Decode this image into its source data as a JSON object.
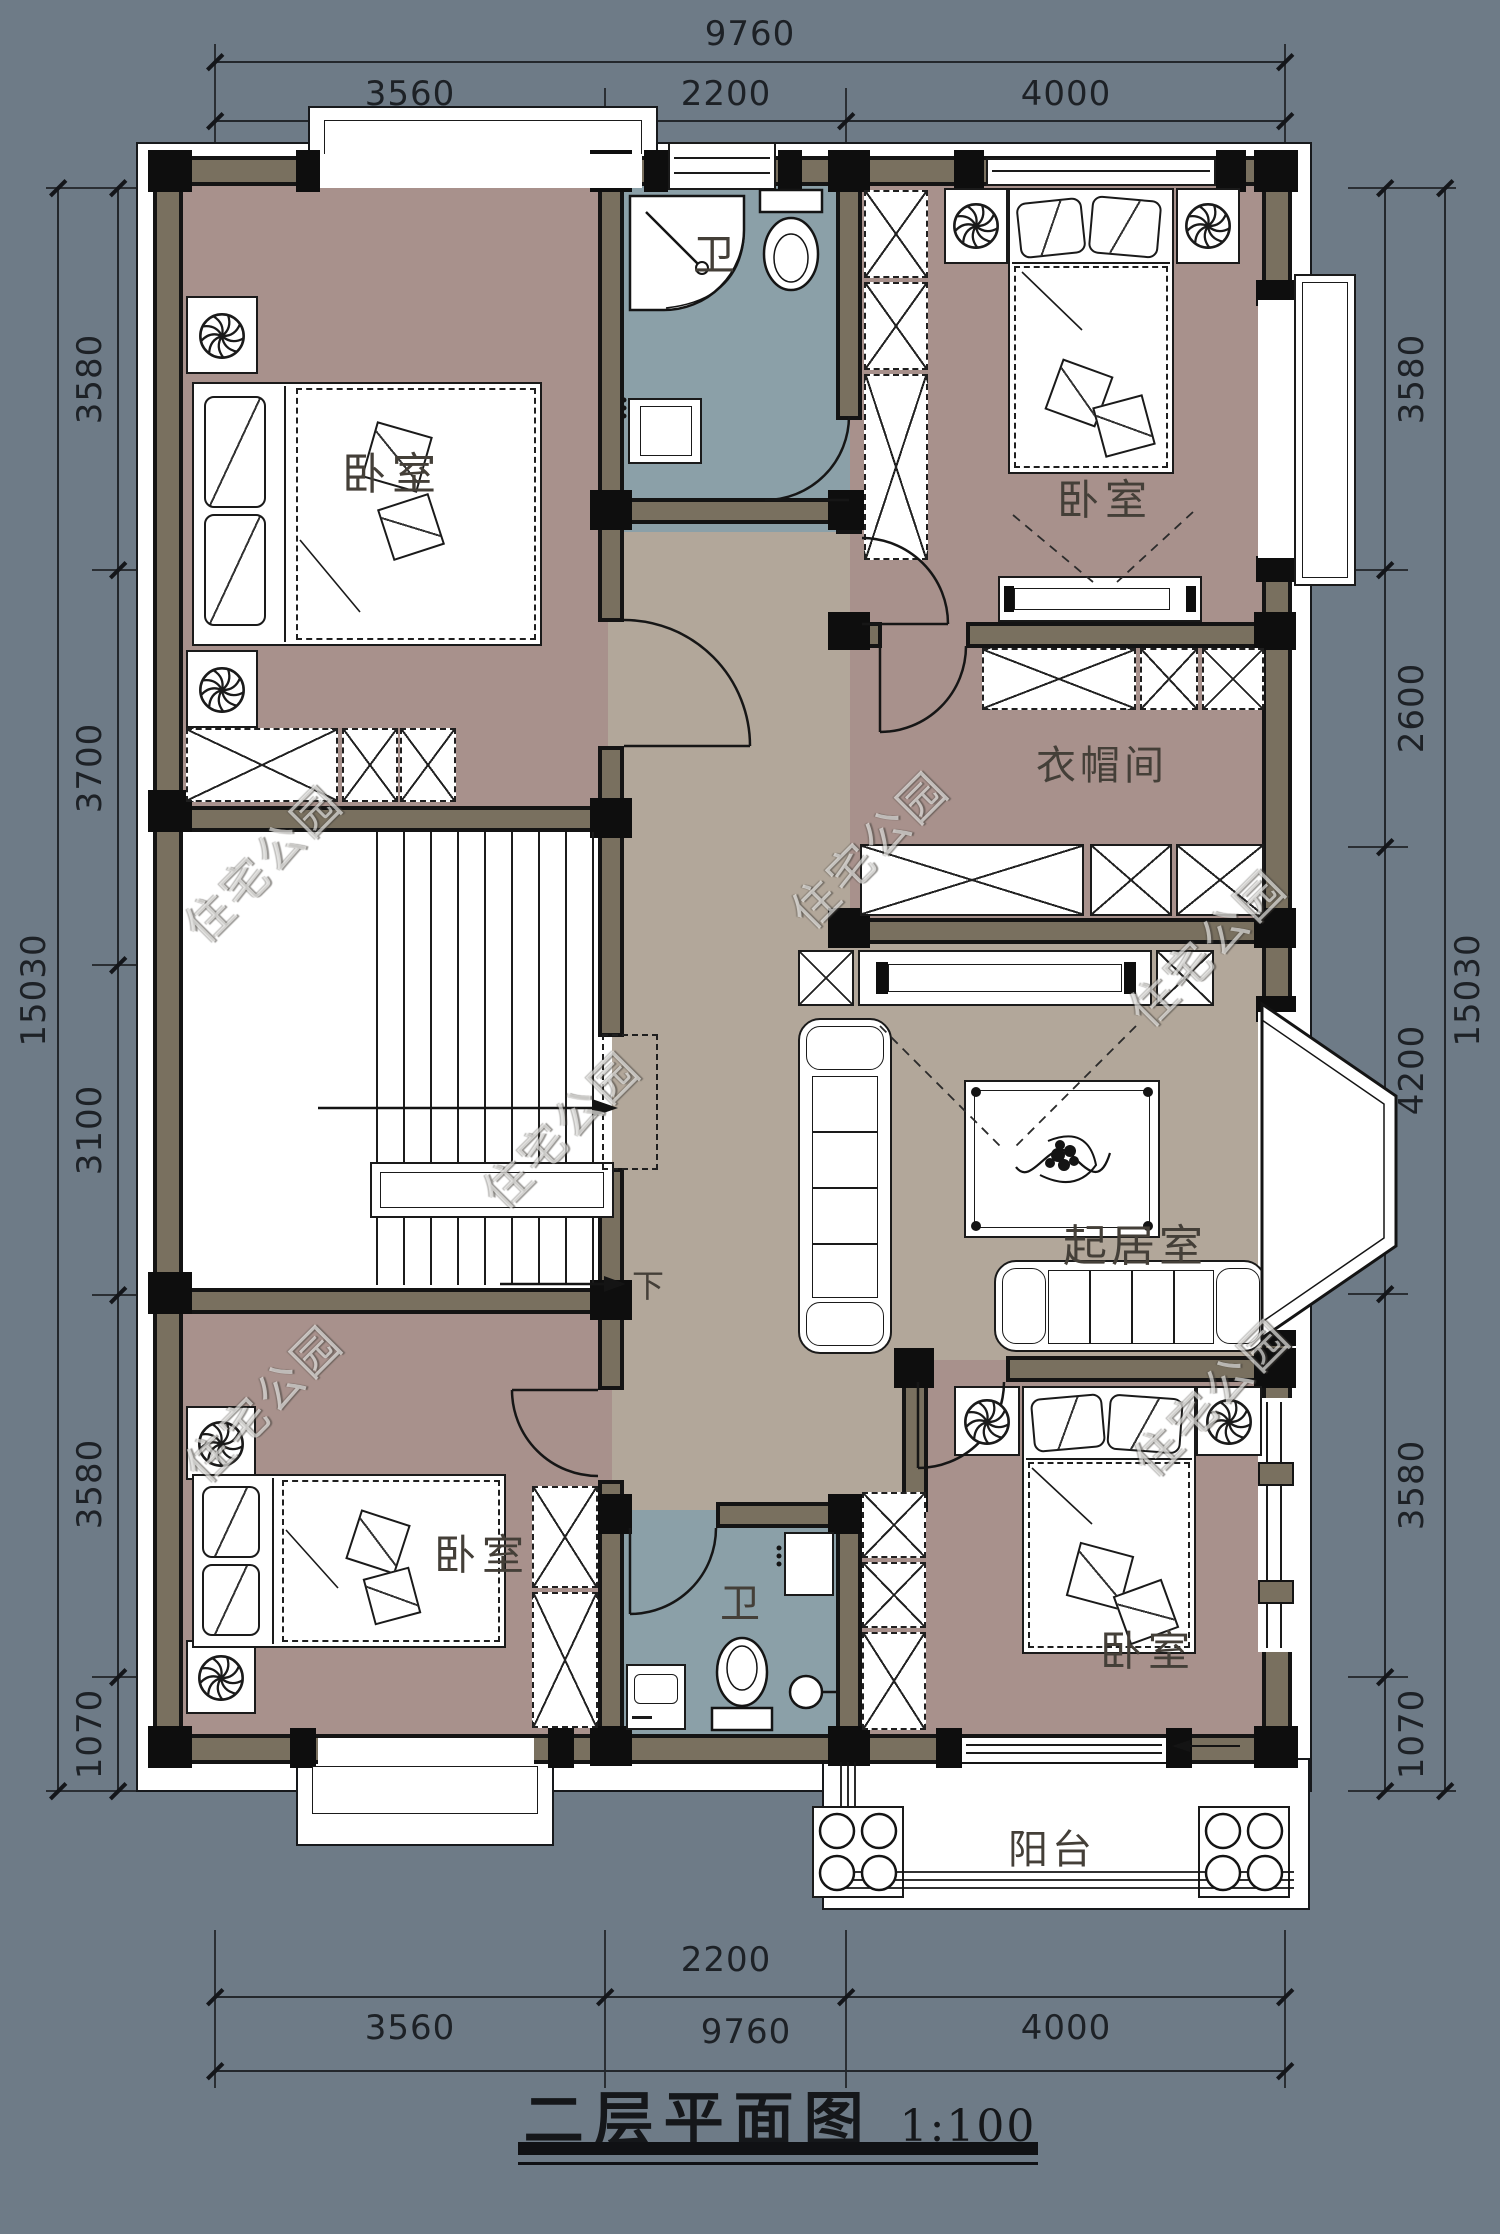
{
  "title": {
    "text": "二层平面图",
    "scale": "1:100"
  },
  "watermark": {
    "text": "住宅公园"
  },
  "stair": {
    "down": "下"
  },
  "dims": {
    "top": {
      "total": "9760",
      "segs": [
        "3560",
        "2200",
        "4000"
      ]
    },
    "bottom": {
      "mid": "2200",
      "left": "3560",
      "center": "9760",
      "right": "4000"
    },
    "left": {
      "total": "15030",
      "segs": [
        "3580",
        "3700",
        "3100",
        "3580",
        "1070"
      ]
    },
    "right": {
      "total": "15030",
      "segs": [
        "3580",
        "2600",
        "4200",
        "3580",
        "1070"
      ]
    }
  },
  "rooms": {
    "bedroom_tl": "卧室",
    "bath_top": "卫",
    "bedroom_tr": "卧室",
    "closet": "衣帽间",
    "living": "起居室",
    "bedroom_bl": "卧室",
    "bath_bottom": "卫",
    "bedroom_br": "卧室",
    "balcony": "阳台"
  },
  "colors": {
    "background": "#6e7b87",
    "wall_fill": "#79705f",
    "line": "#141414",
    "bedroom_floor": "#a8918c",
    "bath_floor": "#8ba0a8",
    "hall_floor": "#b2a79a",
    "balcony_floor": "#ffffff"
  }
}
